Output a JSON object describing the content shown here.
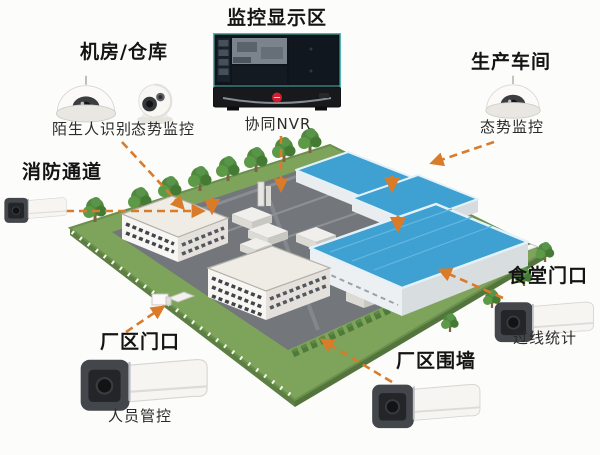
{
  "colors": {
    "connector_orange": "#d97b28",
    "warehouse_roof_blue": "#3fa0d2",
    "grass_green": "#7ea35a",
    "pavement_gray": "#73777c",
    "monitor_edge_teal": "#4fb6b4",
    "brand_logo_red": "#cf2030"
  },
  "zones": {
    "machine_room": {
      "title": "机房/仓库",
      "devices": [
        {
          "icon": "dome-camera",
          "label": "陌生人识别"
        },
        {
          "icon": "eyeball-camera",
          "label": "态势监控"
        }
      ]
    },
    "monitor_display": {
      "title": "监控显示区",
      "devices": [
        {
          "icon": "nvr-monitor",
          "label": "协同NVR"
        }
      ]
    },
    "production_workshop": {
      "title": "生产车间",
      "devices": [
        {
          "icon": "dome-camera",
          "label": "态势监控"
        }
      ]
    },
    "fire_passage": {
      "title": "消防通道",
      "devices": [
        {
          "icon": "bullet-camera"
        }
      ]
    },
    "canteen_entrance": {
      "title": "食堂门口",
      "devices": [
        {
          "icon": "bullet-camera",
          "label": "过线统计"
        }
      ]
    },
    "factory_gate": {
      "title": "厂区门口",
      "devices": [
        {
          "icon": "bullet-camera",
          "label": "人员管控"
        }
      ]
    },
    "perimeter_wall": {
      "title": "厂区围墙",
      "devices": [
        {
          "icon": "bullet-camera"
        }
      ]
    }
  }
}
